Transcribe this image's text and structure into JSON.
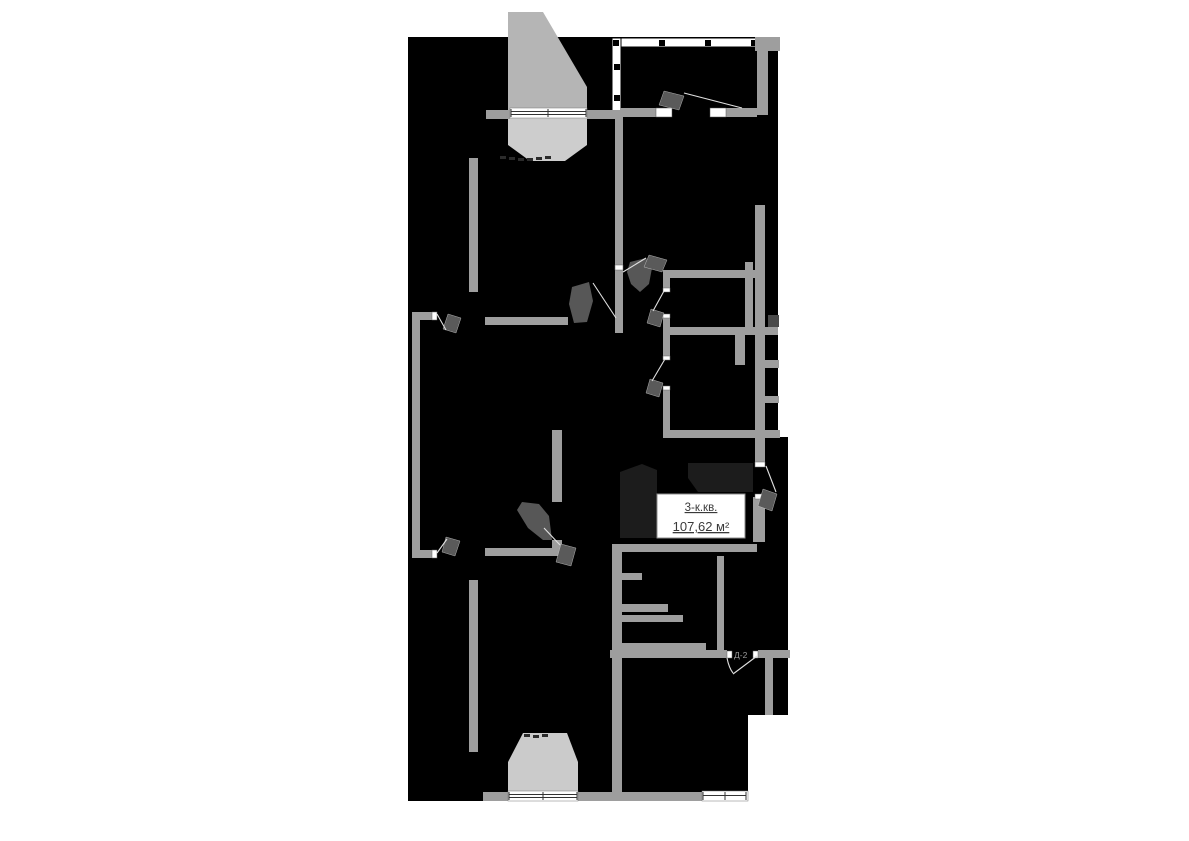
{
  "floor_plan": {
    "apartment_card": {
      "type_label": "3-к.кв.",
      "area_label": "107,62 м²"
    },
    "door_tag": "Д-2",
    "colors": {
      "page_background": "#ffffff",
      "apartment_fill": "#000000",
      "wall": "#9e9e9e",
      "bay_outer": "#b5b5b5",
      "bay_inner": "#cdcdcd",
      "door_leaf": "#5a5a5a",
      "swing_line": "#e0e0e0",
      "vestibule_shade": "#1c1c1c",
      "label_box_border": "#8c8c8c",
      "label_text": "#3a3a3a",
      "door_tag_text": "#9a9a9a",
      "shaft_dark": "#4a4a4a"
    }
  }
}
